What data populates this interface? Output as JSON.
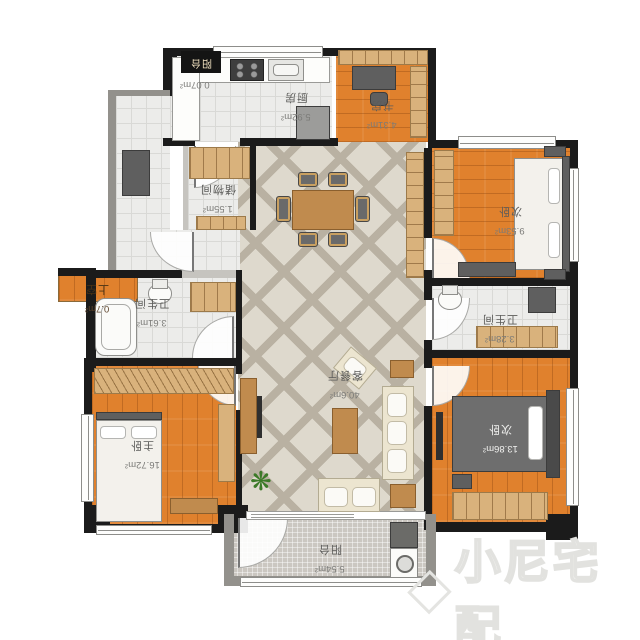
{
  "plan": {
    "rooms": [
      {
        "id": "kitchen",
        "name": "厨房",
        "area": "5.92m²"
      },
      {
        "id": "study",
        "name": "书房",
        "area": "4.31m²"
      },
      {
        "id": "storage",
        "name": "储物间",
        "area": "1.55m²"
      },
      {
        "id": "bedroom_top",
        "name": "次卧",
        "area": "9.53m²"
      },
      {
        "id": "bath_left",
        "name": "卫生间",
        "area": "3.61m²"
      },
      {
        "id": "void",
        "name": "上空",
        "area": "0.7m²"
      },
      {
        "id": "living_dining",
        "name": "客餐厅",
        "area": "40.6m²"
      },
      {
        "id": "bath_right",
        "name": "卫生间",
        "area": "3.28m²"
      },
      {
        "id": "master",
        "name": "主卧",
        "area": "16.72m²"
      },
      {
        "id": "bedroom_bottom",
        "name": "次卧",
        "area": "13.86m²"
      },
      {
        "id": "balcony_top",
        "name": "阳台",
        "area": "0.07m²"
      },
      {
        "id": "balcony_bottom",
        "name": "阳台",
        "area": "5.54m²"
      }
    ],
    "watermark": {
      "text": "小尼宅配"
    },
    "icons": {
      "plant_glyph": "❋"
    },
    "colors": {
      "wall": "#1b1b1b",
      "wood_floor": "#e0812d",
      "living_tile": "#ded9cd",
      "lattice_line": "#b9b1a2",
      "bath_tile": "#ececea",
      "balcony_tile": "#cbc7c1",
      "cabinet": "#d9b27c",
      "furniture_dark": "#5f5f5f",
      "watermark": "#e2e2df"
    }
  }
}
